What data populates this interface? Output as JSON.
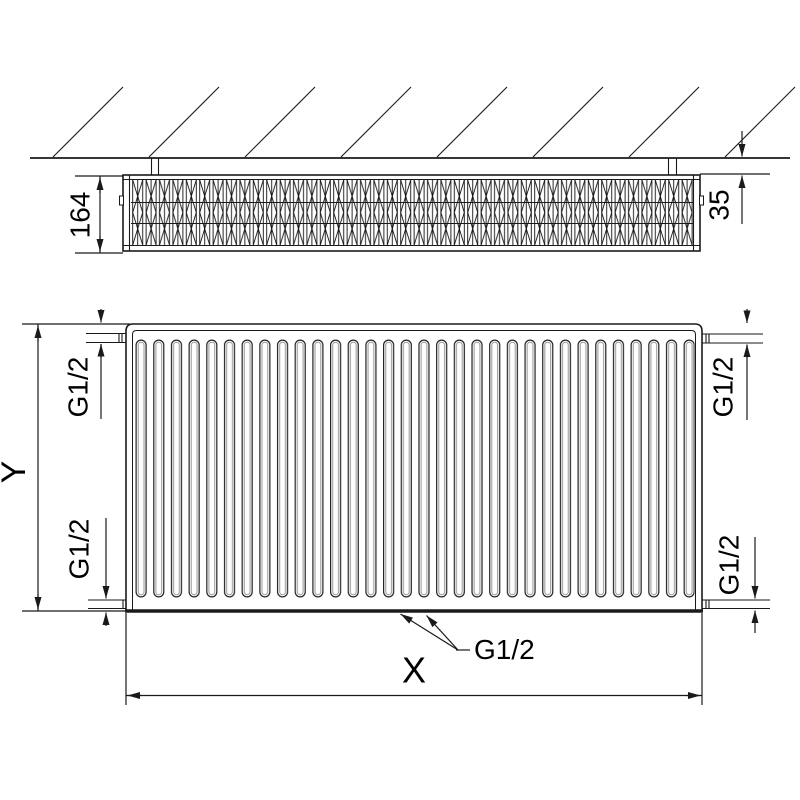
{
  "drawing": {
    "title": "panel-radiator-dimension-drawing",
    "labels": {
      "depth": "164",
      "wall_distance": "35",
      "width": "X",
      "height": "Y",
      "connection": "G1/2"
    },
    "colors": {
      "line": "#1a1a1a",
      "background": "#ffffff",
      "fin_inner_shade": "#999999"
    }
  }
}
